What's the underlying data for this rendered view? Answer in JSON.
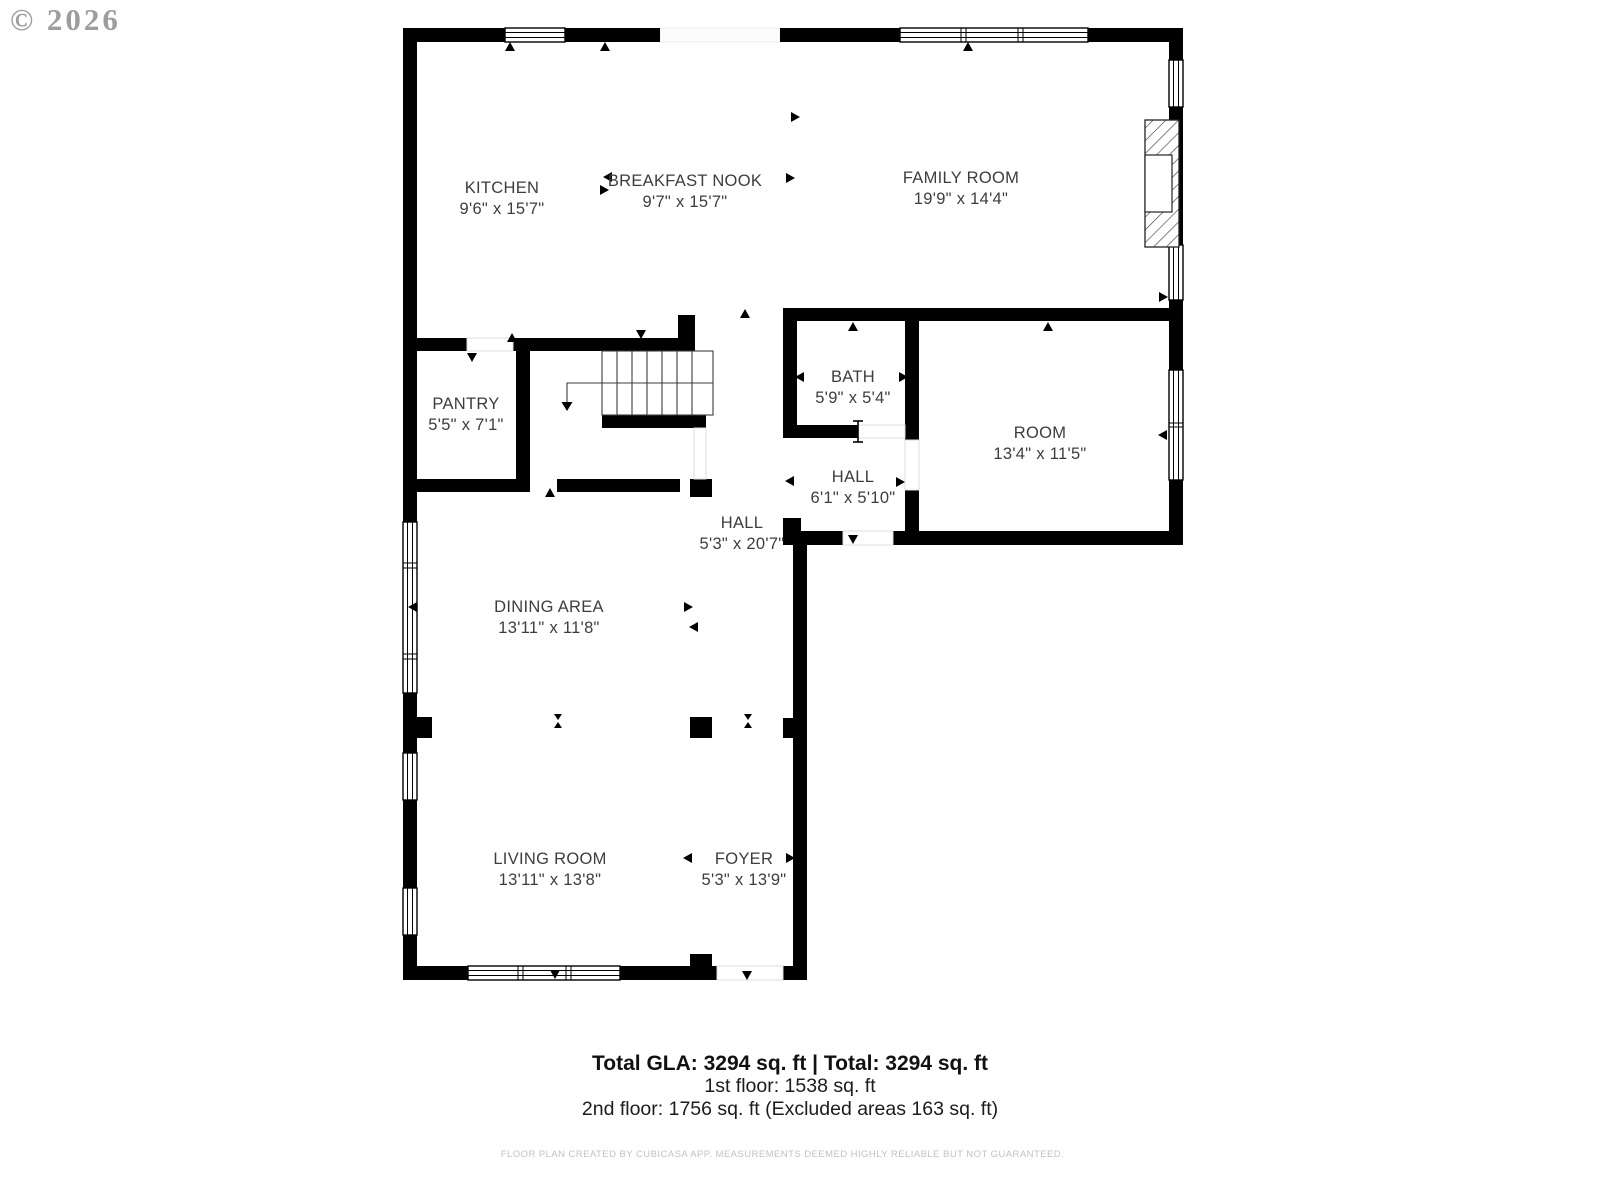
{
  "watermark": "© 2026",
  "rooms": [
    {
      "name": "KITCHEN",
      "dims": "9'6\" x 15'7\""
    },
    {
      "name": "BREAKFAST NOOK",
      "dims": "9'7\" x 15'7\""
    },
    {
      "name": "FAMILY ROOM",
      "dims": "19'9\" x 14'4\""
    },
    {
      "name": "PANTRY",
      "dims": "5'5\" x 7'1\""
    },
    {
      "name": "BATH",
      "dims": "5'9\" x 5'4\""
    },
    {
      "name": "ROOM",
      "dims": "13'4\" x 11'5\""
    },
    {
      "name": "HALL",
      "dims": "6'1\" x 5'10\""
    },
    {
      "name": "HALL",
      "dims": "5'3\" x 20'7\""
    },
    {
      "name": "DINING AREA",
      "dims": "13'11\" x 11'8\""
    },
    {
      "name": "LIVING ROOM",
      "dims": "13'11\" x 13'8\""
    },
    {
      "name": "FOYER",
      "dims": "5'3\" x 13'9\""
    }
  ],
  "summary": {
    "total_line": "Total GLA: 3294 sq. ft | Total: 3294 sq. ft",
    "first_floor": "1st floor: 1538 sq. ft",
    "second_floor": "2nd floor: 1756 sq. ft (Excluded areas 163 sq. ft)"
  },
  "footer": "FLOOR PLAN CREATED BY CUBICASA APP. MEASUREMENTS DEEMED HIGHLY RELIABLE BUT NOT GUARANTEED.",
  "colors": {
    "wall": "#000000",
    "label": "#3d3d3d",
    "watermark": "#8d8d8d",
    "footer": "#c2c2c2"
  }
}
